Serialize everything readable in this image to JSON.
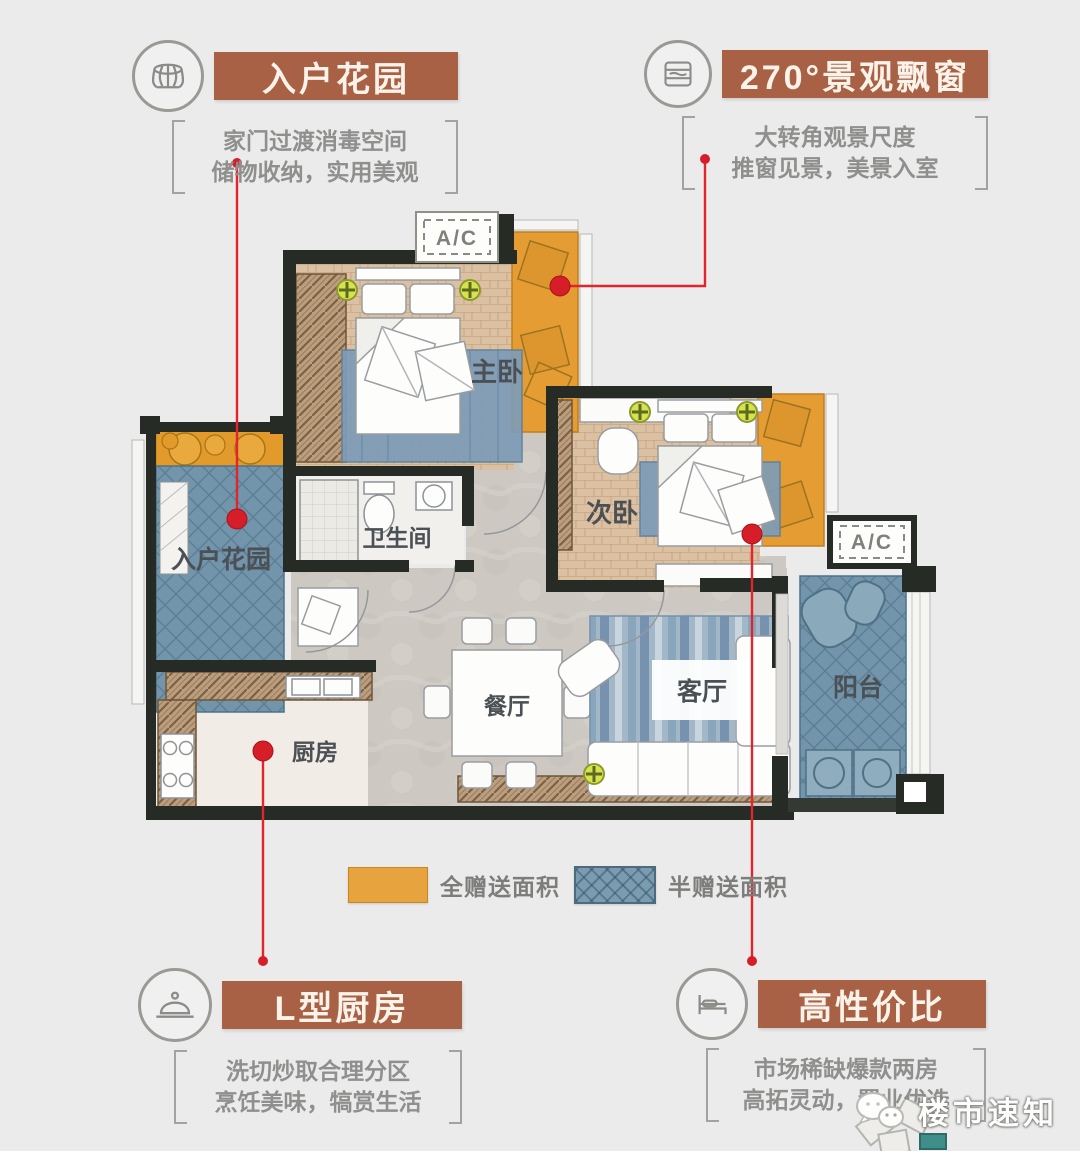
{
  "badges": {
    "top_left": {
      "icon": "basket-icon",
      "title": "入户花园",
      "line1": "家门过渡消毒空间",
      "line2": "储物收纳，实用美观"
    },
    "top_right": {
      "icon": "window-icon",
      "title": "270°景观飘窗",
      "line1": "大转角观景尺度",
      "line2": "推窗见景，美景入室"
    },
    "bottom_left": {
      "icon": "cloche-icon",
      "title": "L型厨房",
      "line1": "洗切炒取合理分区",
      "line2": "烹饪美味，犒赏生活"
    },
    "bottom_right": {
      "icon": "bed-icon",
      "title": "高性价比",
      "line1": "市场稀缺爆款两房",
      "line2": "高拓灵动，置业优选"
    }
  },
  "rooms": {
    "master": "主卧",
    "second": "次卧",
    "bathroom": "卫生间",
    "entry_garden": "入户花园",
    "kitchen": "厨房",
    "dining": "餐厅",
    "living": "客厅",
    "balcony": "阳台"
  },
  "ac_label": "A/C",
  "legend": {
    "full_label": "全赠送面积",
    "half_label": "半赠送面积",
    "full_color": "#e7a43e",
    "half_color": "#7b9cb0"
  },
  "watermark": {
    "text": "楼市速知",
    "icon": "wechat-icon"
  },
  "colors": {
    "banner": "#a96146",
    "annotation_red": "#e2242c",
    "bay_window_orange": "#e59d33",
    "gifted_blue": "#7295ab",
    "wall_dark": "#262b25",
    "background": "#ecebec"
  }
}
